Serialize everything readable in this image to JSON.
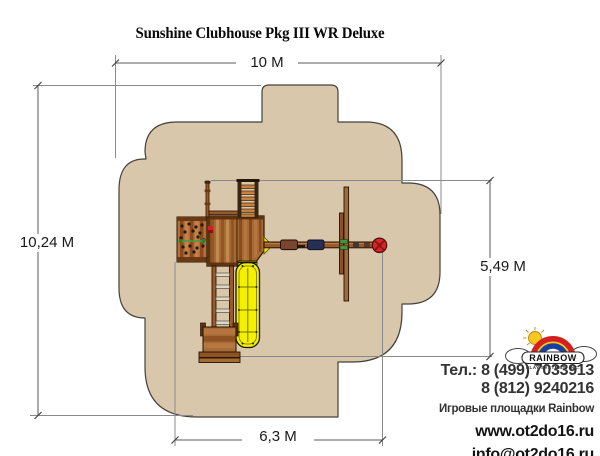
{
  "title": "Sunshine Clubhouse Pkg III WR Deluxe",
  "dimensions": {
    "zone_width": "10 M",
    "zone_height": "10,24 M",
    "structure_height": "5,49 M",
    "structure_width": "6,3 M"
  },
  "contact": {
    "phone1": "Тел.: 8 (499) 7033913",
    "phone2": "8 (812) 9240216",
    "tagline": "Игровые площадки Rainbow",
    "website": "www.ot2do16.ru",
    "email": "info@ot2do16.ru"
  },
  "logo": {
    "brand": "RAINBOW",
    "subtitle": "PLAY SYSTEMS, INC."
  },
  "colors": {
    "safety_zone": "#d9c7ac",
    "zone_outline": "#45413a",
    "wood_brown": "#9c5a28",
    "wood_dark": "#241306",
    "slide_yellow": "#f4f000",
    "tire_red": "#d42626",
    "seat_navy": "#263056",
    "seat_brown": "#7a452c",
    "rope_green": "#3f9e3f",
    "dim_line_gray": "#8a8a8a"
  }
}
